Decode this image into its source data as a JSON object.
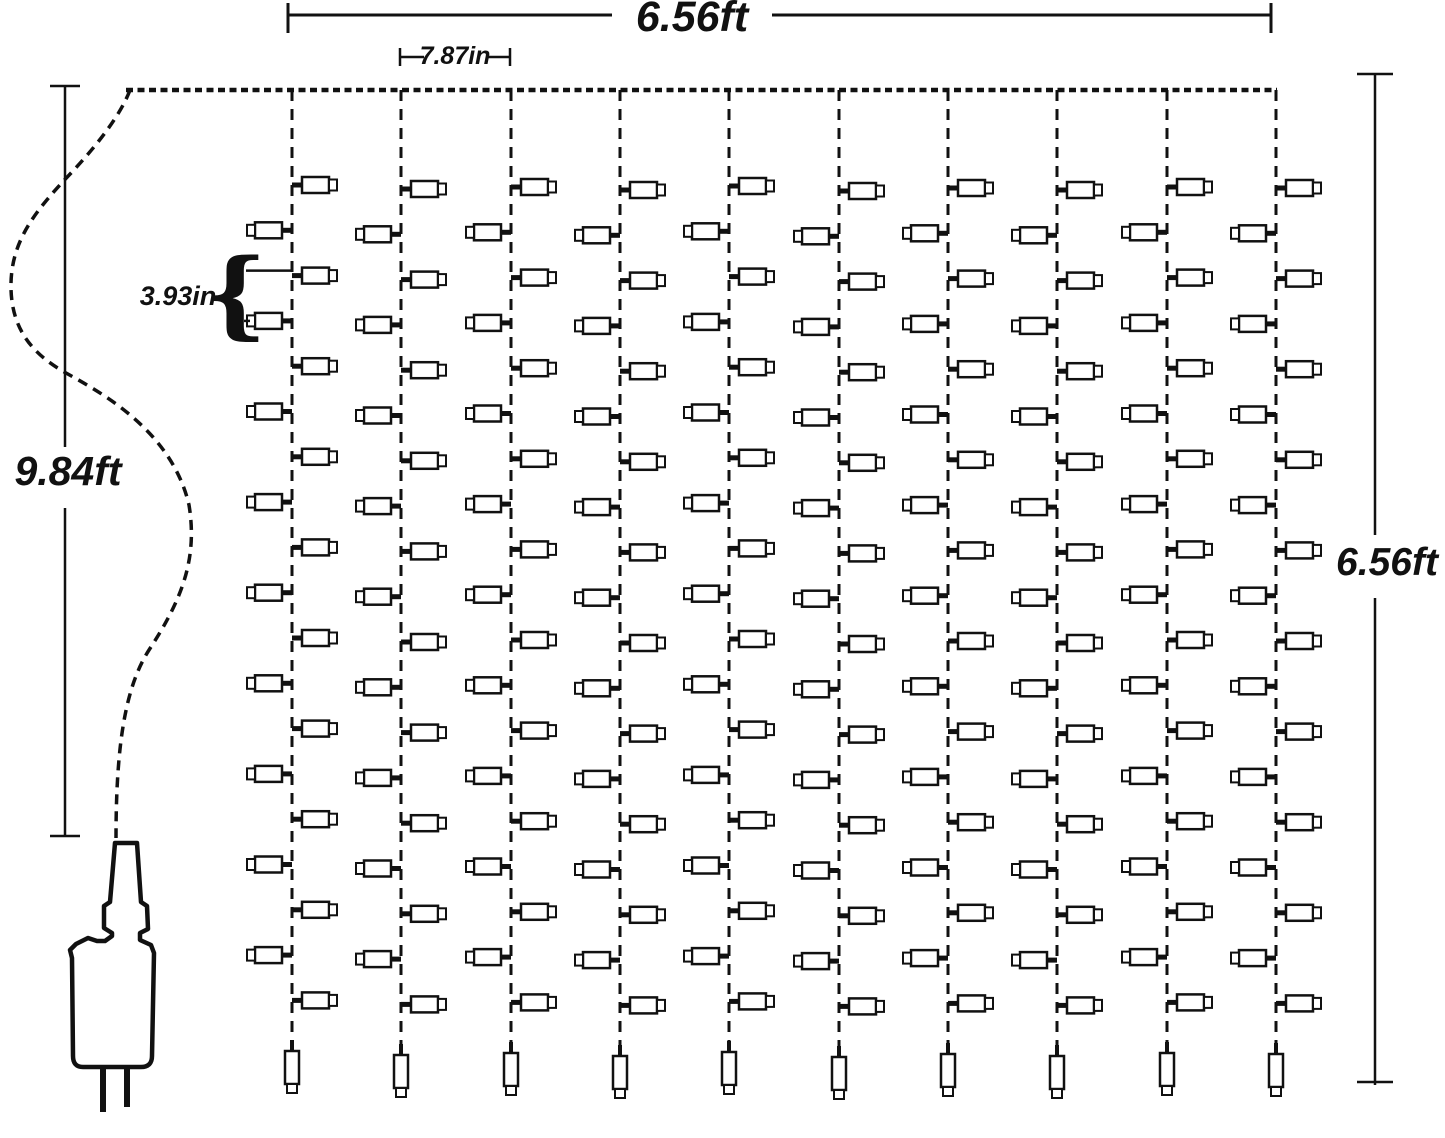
{
  "diagram": {
    "curtain_width_label": "6.56ft",
    "strand_spacing_label": "7.87in",
    "light_spacing_label": "3.93in",
    "lead_wire_label": "9.84ft",
    "drop_height_label": "6.56ft",
    "brace_glyph": "{",
    "structure": {
      "strand_count": 10,
      "lights_per_strand": 19,
      "end_lights_per_strand": 1,
      "strand_offsets_px": [
        0,
        4,
        2,
        5,
        1,
        6,
        3,
        5,
        2,
        3
      ]
    },
    "colors": {
      "ink": "#111111",
      "background": "#ffffff"
    }
  }
}
